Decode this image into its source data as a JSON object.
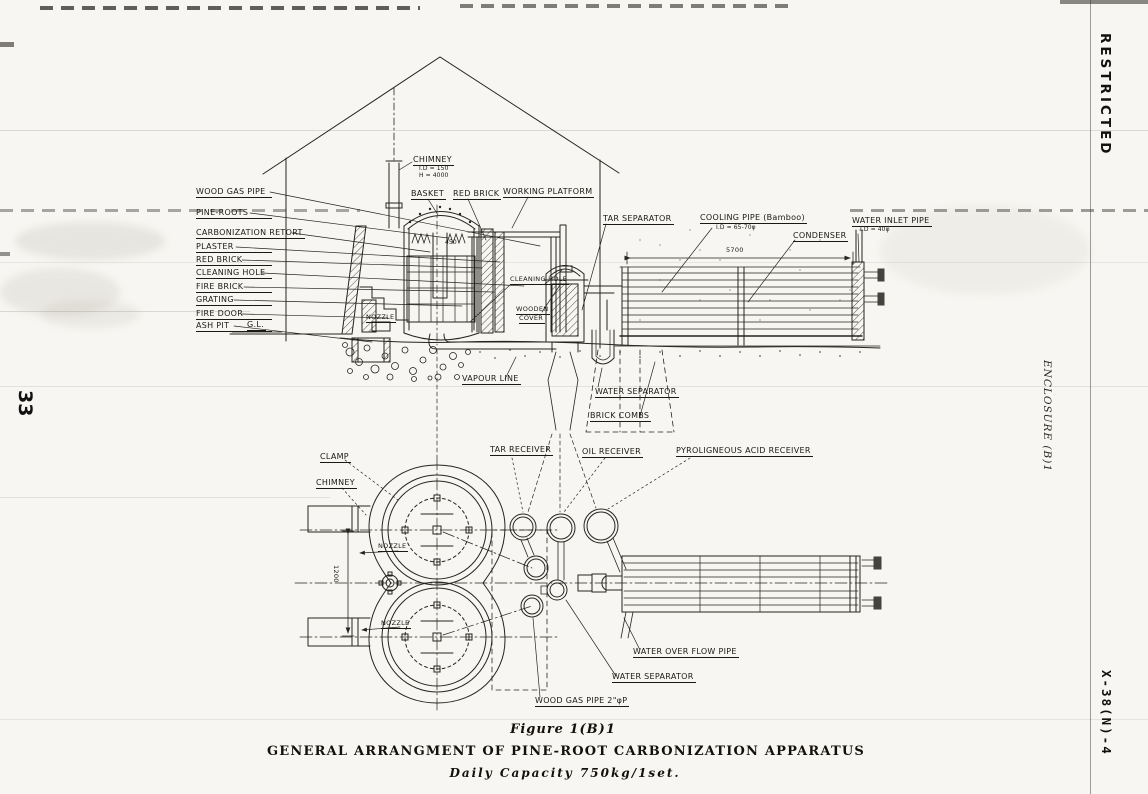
{
  "page_number": "33",
  "margin": {
    "restricted": "RESTRICTED",
    "enclosure": "ENCLOSURE (B)1",
    "doc_ref": "X-38(N)-4"
  },
  "caption": {
    "figure": "Figure 1(B)1",
    "title": "GENERAL ARRANGMENT OF PINE-ROOT CARBONIZATION APPARATUS",
    "subtitle": "Daily Capacity 750kg/1set."
  },
  "dimensions": {
    "length": "5700",
    "width": "1200",
    "retort": "450"
  },
  "elevation": {
    "labels": {
      "wood_gas_pipe": "WOOD GAS PIPE",
      "pine_roots": "PINE-ROOTS",
      "carbonization_retort": "CARBONIZATION RETORT",
      "plaster": "PLASTER",
      "red_brick": "RED BRICK",
      "cleaning_hole": "CLEANING HOLE",
      "fire_brick": "FIRE BRICK",
      "grating": "GRATING",
      "fire_door": "FIRE DOOR",
      "ash_pit": "ASH PIT",
      "ground_level": "G.L.",
      "nozzle": "NOZZLE",
      "chimney": "CHIMNEY",
      "chimney_id": "I.D = 150",
      "chimney_h": "H = 4000",
      "basket": "BASKET",
      "red_brick_top": "RED BRICK",
      "working_platform": "WORKING PLATFORM",
      "cleaning_hole_mid": "CLEANING HOLE",
      "wooden_cover_line1": "WOODEN",
      "wooden_cover_line2": "COVER",
      "vapour_line": "VAPOUR LINE",
      "water_separator": "WATER SEPARATOR",
      "brick_combs": "BRICK COMBS",
      "tar_separator": "TAR SEPARATOR",
      "cooling_pipe": "COOLING PIPE (Bamboo)",
      "cooling_pipe_id": "I.D = 65-70φ",
      "condenser": "CONDENSER",
      "water_inlet_pipe": "WATER INLET PIPE",
      "water_inlet_id": "I.D = 40φ"
    }
  },
  "plan": {
    "labels": {
      "clamp": "CLAMP",
      "chimney": "CHIMNEY",
      "nozzle_top": "NOZZLE",
      "nozzle_bottom": "NOZZLE",
      "tar_receiver": "TAR RECEIVER",
      "oil_receiver": "OIL RECEIVER",
      "pyroligneous_acid_receiver": "PYROLIGNEOUS ACID RECEIVER",
      "water_overflow_pipe": "WATER OVER FLOW PIPE",
      "water_separator": "WATER SEPARATOR",
      "wood_gas_pipe": "WOOD GAS PIPE 2\"φP"
    }
  }
}
